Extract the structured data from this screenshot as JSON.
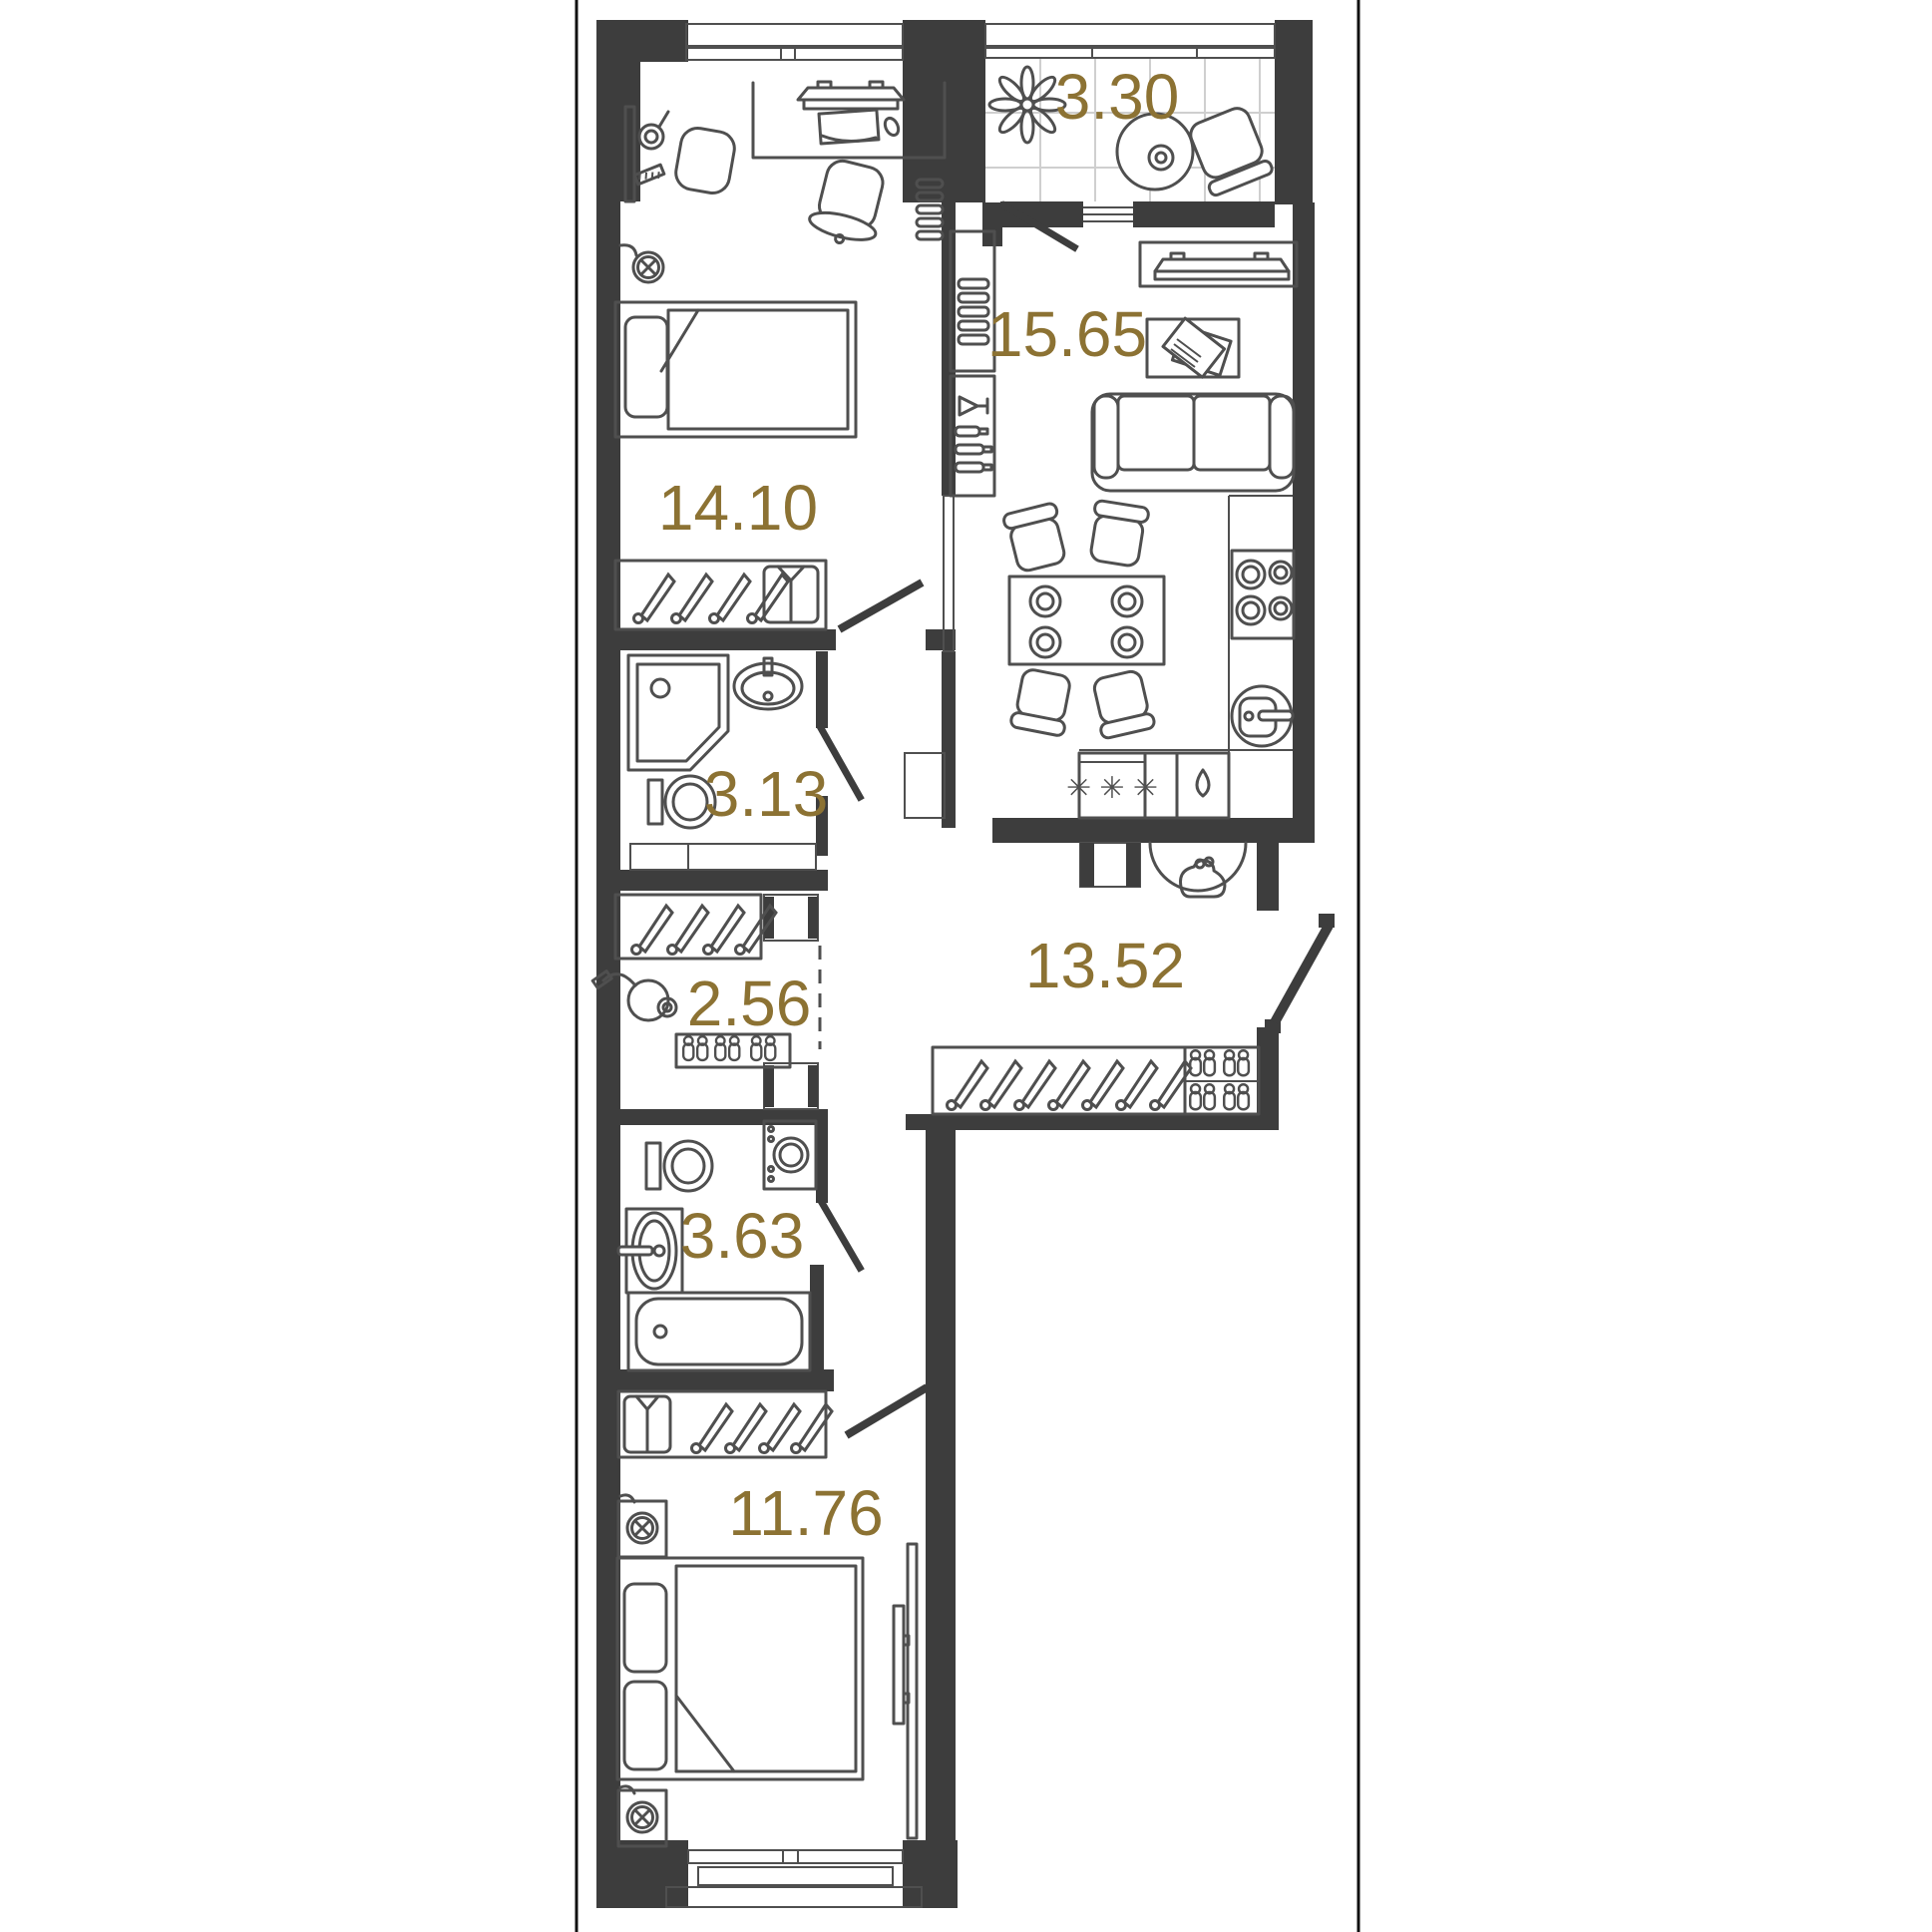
{
  "plan": {
    "type": "apartment-floor-plan",
    "rooms": [
      {
        "name": "bedroom-1",
        "area": "14.10"
      },
      {
        "name": "loggia",
        "area": "3.30"
      },
      {
        "name": "kitchen-living-room",
        "area": "15.65"
      },
      {
        "name": "shower-room",
        "area": "3.13"
      },
      {
        "name": "storage",
        "area": "2.56"
      },
      {
        "name": "hallway",
        "area": "13.52"
      },
      {
        "name": "bathroom",
        "area": "3.63"
      },
      {
        "name": "bedroom-2",
        "area": "11.76"
      }
    ],
    "symbols": {
      "freezer": "✳ ✳ ✳"
    },
    "colors": {
      "wall": "#3d3d3d",
      "furniture_line": "#4f4f4f",
      "room_label": "#8c7233",
      "tile_grid": "#cfcfcf",
      "page_border": "#111111",
      "background": "#ffffff"
    }
  }
}
